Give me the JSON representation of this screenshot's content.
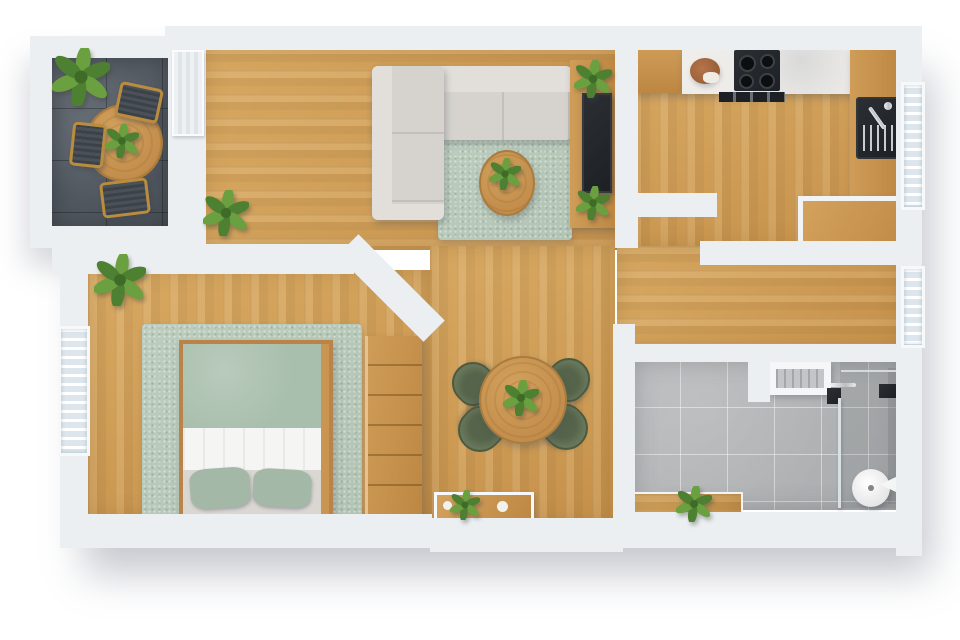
{
  "scene": {
    "type": "3d-floor-plan-top-down-render",
    "title": "One-bedroom apartment floor plan",
    "rooms": [
      {
        "name": "balcony",
        "floor": "dark-slate-tile",
        "furniture": [
          "round-bistro-table",
          "gold-frame-chair x3",
          "potted-plant",
          "table-plant"
        ]
      },
      {
        "name": "living-room",
        "floor": "oak-plank",
        "furniture": [
          "l-shaped-sectional-sofa",
          "green-throw-pillow x2",
          "beige-throw-pillow",
          "sage-area-rug",
          "round-coffee-table",
          "coffee-table-plant",
          "tv-media-console",
          "flat-screen-tv",
          "console-plant x2",
          "floor-plant"
        ]
      },
      {
        "name": "kitchen",
        "floor": "oak-plank",
        "furniture": [
          "marble-countertop",
          "gas-cooktop",
          "cutting-board-with-bread",
          "oven-front",
          "side-counter",
          "basin-sink-with-faucet",
          "window-bench"
        ]
      },
      {
        "name": "bedroom",
        "floor": "oak-plank",
        "furniture": [
          "double-bed",
          "sage-duvet",
          "white-folded-blanket",
          "sage-pillow x2",
          "sage-area-rug",
          "chest-of-drawers",
          "potted-plant"
        ]
      },
      {
        "name": "dining-area",
        "floor": "oak-plank",
        "furniture": [
          "round-dining-table",
          "olive-chair x4",
          "table-plant",
          "console-shelf",
          "console-plant",
          "decor-dish x2"
        ]
      },
      {
        "name": "hallway",
        "floor": "oak-plank",
        "furniture": []
      },
      {
        "name": "bathroom",
        "floor": "gray-ceramic-tile",
        "furniture": [
          "vanity-basin",
          "chrome-mixer",
          "glass-shower-screen",
          "shower-control",
          "round-shower-tray",
          "towel-holder",
          "entry-nook-plant"
        ]
      }
    ],
    "windows": [
      "bedroom-west-window",
      "kitchen-east-window",
      "hallway-east-window",
      "balcony-sliding-door"
    ],
    "text_labels": []
  },
  "colors": {
    "wall": "#eceff2",
    "wood": "#d0a05c",
    "woodFurniture": "#c28c4b",
    "slateDark": "#4e555e",
    "tileGray": "#b3b5b7",
    "rugSage": "#b2c4b4",
    "duvetSage": "#a9bfad",
    "pillowSage": "#a3b8a7",
    "blanketWhite": "#f5f5f3",
    "sofaGray": "#d6d3ce",
    "sofaLight": "#e2dfda",
    "oliveChair": "#68775a",
    "oliveDark": "#55644a",
    "goldFrame": "#b98c3e",
    "darkAppliance": "#1d2024",
    "chrome": "#c9cdd0",
    "marble": "#eae8e5",
    "leafLight": "#6aa03f",
    "leafDark": "#4d8030",
    "potGray": "#7a7e83",
    "glassBlue": "#dde6ec"
  }
}
